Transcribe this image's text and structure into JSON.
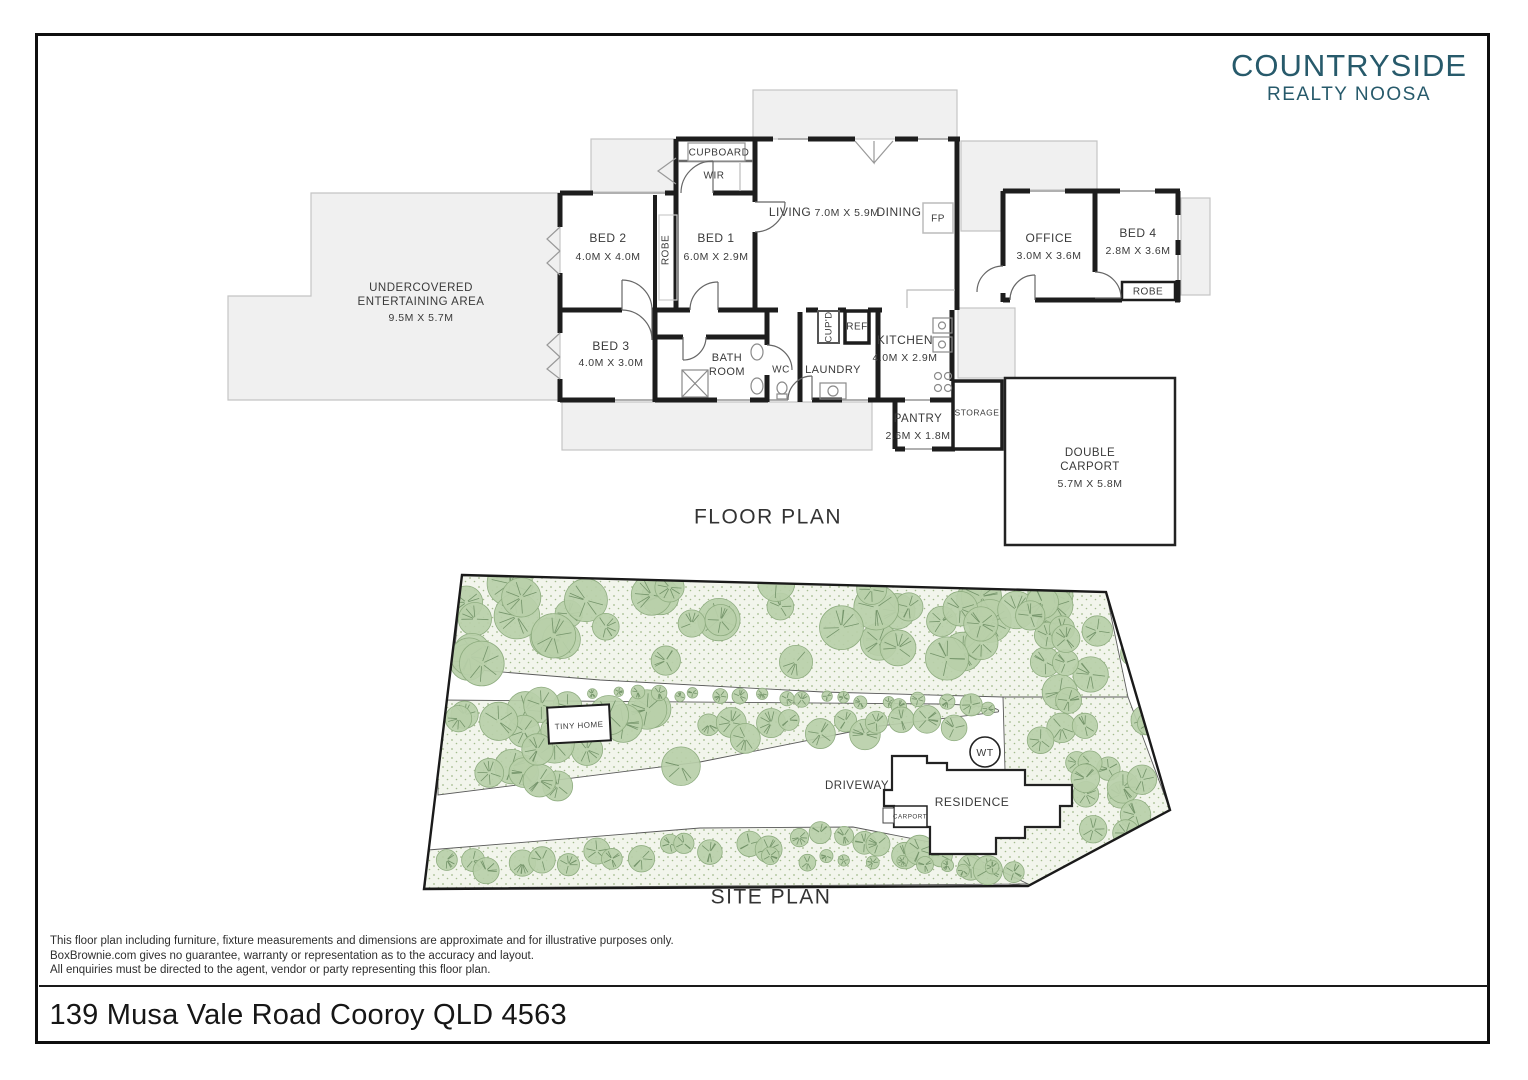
{
  "brand": {
    "name": "COUNTRYSIDE",
    "tagline": "REALTY NOOSA",
    "color": "#275a6b"
  },
  "floor_plan": {
    "title": "FLOOR PLAN",
    "rooms": {
      "cupboard": "CUPBOARD",
      "wir": "WIR",
      "bed2": {
        "name": "BED 2",
        "dim": "4.0M X 4.0M"
      },
      "robe_bed2": "ROBE",
      "bed1": {
        "name": "BED 1",
        "dim": "6.0M X 2.9M"
      },
      "living": "LIVING",
      "living_dining_dim": "7.0M X 5.9M",
      "dining": "DINING",
      "fireplace": "FP",
      "office": {
        "name": "OFFICE",
        "dim": "3.0M X 3.6M"
      },
      "bed4": {
        "name": "BED 4",
        "dim": "2.8M X 3.6M"
      },
      "robe_bed4": "ROBE",
      "entertaining": {
        "line1": "UNDERCOVERED",
        "line2": "ENTERTAINING AREA",
        "dim": "9.5M X 5.7M"
      },
      "bed3": {
        "name": "BED 3",
        "dim": "4.0M X 3.0M"
      },
      "bathroom": {
        "line1": "BATH",
        "line2": "ROOM"
      },
      "wc": "WC",
      "laundry": "LAUNDRY",
      "cupd": "CUP'D",
      "ref": "REF",
      "kitchen": {
        "name": "KITCHEN",
        "dim": "4.0M X 2.9M"
      },
      "pantry": {
        "name": "PANTRY",
        "dim": "2.6M X 1.8M"
      },
      "storage": "STORAGE",
      "double_carport": {
        "line1": "DOUBLE",
        "line2": "CARPORT",
        "dim": "5.7M X 5.8M"
      }
    }
  },
  "site_plan": {
    "title": "SITE PLAN",
    "labels": {
      "tiny_home": "TINY HOME",
      "driveway": "DRIVEWAY",
      "water_tank": "WT",
      "residence": "RESIDENCE",
      "carport": "CARPORT"
    }
  },
  "disclaimer": {
    "line1": "This floor plan including furniture, fixture measurements and dimensions are approximate and for illustrative purposes only.",
    "line2": "BoxBrownie.com gives no guarantee, warranty or representation as to the accuracy and layout.",
    "line3": "All enquiries must be directed to the agent, vendor or party representing this floor plan."
  },
  "address": "139 Musa Vale Road Cooroy QLD 4563"
}
